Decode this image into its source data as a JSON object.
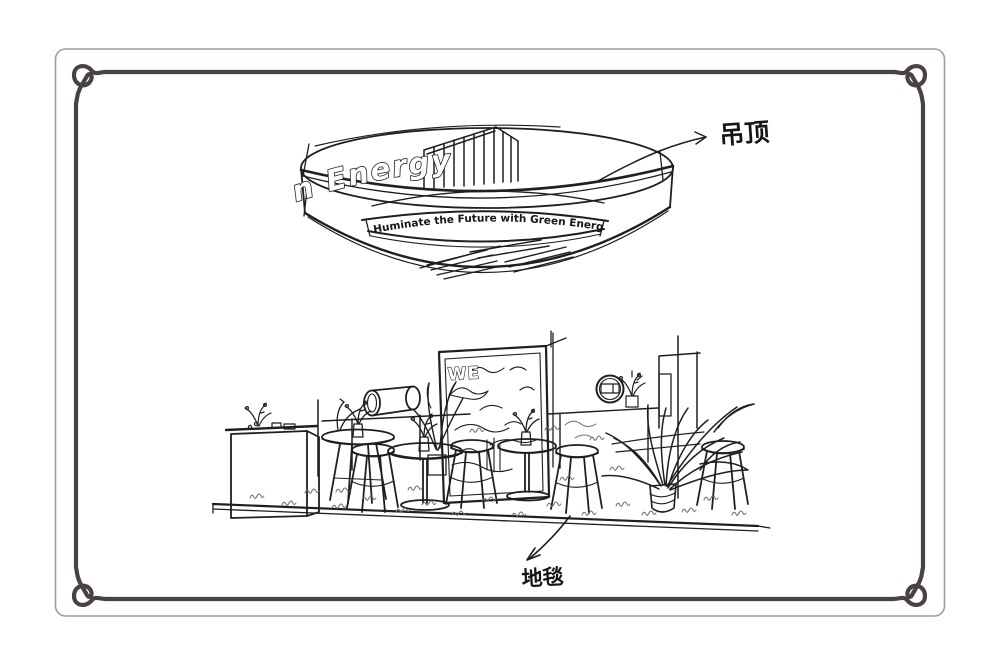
{
  "colors": {
    "ink": "#1f1f1f",
    "frame": "#4a4242",
    "outer_border": "#a29c9a",
    "scribble": "#6b6b6b"
  },
  "ceiling": {
    "band_text": "n Energy",
    "slogan": "Huminate the Future with Green Energy",
    "annotation": "吊顶"
  },
  "booth": {
    "poster_text": "WE"
  },
  "floor": {
    "annotation": "地毯"
  }
}
